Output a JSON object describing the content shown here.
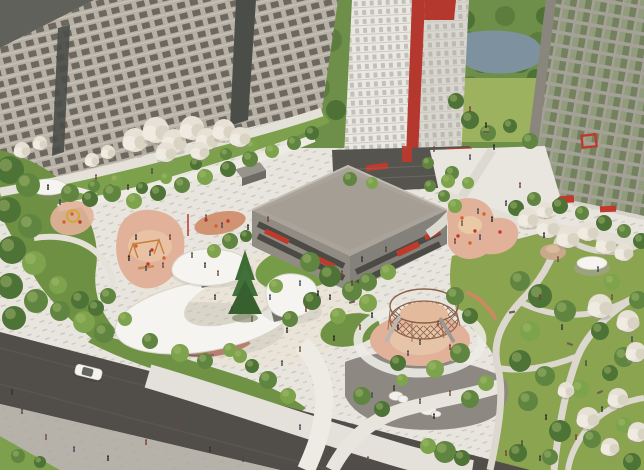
{
  "meta": {
    "type": "architectural-aerial-render",
    "title": "Residential courtyard masterplan — aerial visualization",
    "width": 644,
    "height": 470
  },
  "palette": {
    "plaza": "#e8e5de",
    "plaza_warm": "#eadfce",
    "stipple": "#a9a49a",
    "path": "#edebe4",
    "path_grey": "#d9d5cc",
    "path_narrow": "#dcd8cf",
    "road": "#514e4a",
    "road_streak": "#5c5954",
    "sidewalk": "#b6b2aa",
    "grass_corner": "#7da04e",
    "lawn": "#8ba450",
    "lawn_light": "#9cb25f",
    "garden_green": "#7ca04b",
    "edge_green": "#6d9043",
    "roadside_green": "#6f9245",
    "backdrop_green": "#6e8f49",
    "lake": "#7d929e",
    "dark_plaza": "#8d8982",
    "boulder": "#f2f0ea",
    "bldg_left": "#b6b0a5",
    "bldg_left_base": "#97928a",
    "glazing": "#4a4d48",
    "roof_dark": "#60615a",
    "tower_front": "#eae8e2",
    "tower_side": "#d9d6cf",
    "tower_base": "#56544f",
    "red": "#b5382e",
    "red_bright": "#c0392b",
    "bldg_right_frame": "#a5a198",
    "glass_a": "#73815f",
    "glass_b": "#99a383",
    "podium_roof": "#a9a399",
    "podium_face": "#908c84",
    "podium_face2": "#84807a",
    "podium_band": "#4c4a45",
    "canopy": "#f5f4f0",
    "canopy_edge": "#d8d4cb",
    "pavilion_wall": "#b97f6e",
    "pavilion_dark": "#6b6862",
    "pg_pink": "#e2b199",
    "pg_sand": "#ecd0a8",
    "pg_terra": "#cf8a66",
    "equip_orange": "#d2622e",
    "structure_brown": "#8a5f46",
    "spruce": "#3f6b34",
    "car_body": "#f4f3ef",
    "bush_colors": [
      "#4e7336",
      "#5f8540",
      "#7da34c",
      "#93ad5b"
    ],
    "people_colors": [
      "#33312e",
      "#4a4640",
      "#6e4a3c",
      "#39465c",
      "#262522",
      "#7b3b32"
    ]
  },
  "scene": {
    "buildings": [
      {
        "id": "left-slab",
        "label": "beige residential slab with glazed stair strips"
      },
      {
        "id": "white-tower",
        "label": "white tower with red corner stripe and red crown block"
      },
      {
        "id": "right-slab",
        "label": "grey slab with green reflective glazing and red framed window"
      },
      {
        "id": "podium",
        "label": "low grey podium building with louvered bands and red awnings"
      },
      {
        "id": "shed",
        "label": "small utility pavilion"
      }
    ],
    "canopies": [
      {
        "id": "crescent-canopy",
        "label": "white crescent canopy over terracotta pavilion"
      },
      {
        "id": "wave-canopy",
        "label": "white wavy canopy pavilion"
      },
      {
        "id": "round-canopy",
        "label": "white round canopy pavilion"
      },
      {
        "id": "umbrella-left",
        "label": "small white umbrella"
      },
      {
        "id": "umbrella-right",
        "label": "park umbrella on patio"
      }
    ],
    "playgrounds": [
      {
        "id": "swing-playground",
        "label": "pink playground with swings"
      },
      {
        "id": "toddler-playground",
        "label": "small pink playground with yellow ring"
      },
      {
        "id": "terra-playground",
        "label": "terracotta activity patch"
      },
      {
        "id": "dome-playground",
        "label": "circular rope climbing pavilion with slides"
      },
      {
        "id": "east-playground",
        "label": "pink playground with orange equipment"
      }
    ],
    "road": {
      "car": "white sedan",
      "lanes": "two-lane asphalt with sidewalk"
    },
    "backdrop": {
      "lake": true,
      "tree_line": true
    },
    "people": [
      [
        12,
        395
      ],
      [
        22,
        414
      ],
      [
        46,
        440
      ],
      [
        74,
        452
      ],
      [
        108,
        461
      ],
      [
        146,
        445
      ],
      [
        210,
        452
      ],
      [
        243,
        462
      ],
      [
        178,
        430
      ],
      [
        60,
        205
      ],
      [
        48,
        190
      ],
      [
        96,
        180
      ],
      [
        128,
        190
      ],
      [
        152,
        174
      ],
      [
        206,
        220
      ],
      [
        222,
        228
      ],
      [
        248,
        230
      ],
      [
        268,
        222
      ],
      [
        136,
        240
      ],
      [
        150,
        256
      ],
      [
        163,
        268
      ],
      [
        146,
        271
      ],
      [
        129,
        261
      ],
      [
        170,
        240
      ],
      [
        215,
        300
      ],
      [
        232,
        312
      ],
      [
        252,
        322
      ],
      [
        270,
        300
      ],
      [
        287,
        333
      ],
      [
        306,
        312
      ],
      [
        330,
        300
      ],
      [
        352,
        286
      ],
      [
        300,
        352
      ],
      [
        282,
        366
      ],
      [
        334,
        341
      ],
      [
        360,
        330
      ],
      [
        205,
        268
      ],
      [
        192,
        258
      ],
      [
        218,
        276
      ],
      [
        300,
        286
      ],
      [
        318,
        296
      ],
      [
        342,
        276
      ],
      [
        362,
        262
      ],
      [
        386,
        252
      ],
      [
        434,
        152
      ],
      [
        470,
        160
      ],
      [
        494,
        150
      ],
      [
        520,
        188
      ],
      [
        506,
        206
      ],
      [
        478,
        214
      ],
      [
        462,
        226
      ],
      [
        480,
        240
      ],
      [
        492,
        222
      ],
      [
        455,
        244
      ],
      [
        398,
        330
      ],
      [
        420,
        345
      ],
      [
        438,
        326
      ],
      [
        408,
        356
      ],
      [
        372,
        318
      ],
      [
        450,
        350
      ],
      [
        394,
        391
      ],
      [
        420,
        404
      ],
      [
        450,
        396
      ],
      [
        372,
        398
      ],
      [
        434,
        419
      ],
      [
        540,
        300
      ],
      [
        562,
        330
      ],
      [
        586,
        366
      ],
      [
        612,
        300
      ],
      [
        632,
        342
      ],
      [
        546,
        420
      ],
      [
        576,
        440
      ],
      [
        602,
        412
      ],
      [
        522,
        446
      ],
      [
        558,
        262
      ],
      [
        598,
        272
      ],
      [
        544,
        238
      ],
      [
        506,
        456
      ],
      [
        540,
        461
      ],
      [
        330,
        452
      ],
      [
        368,
        462
      ],
      [
        300,
        430
      ],
      [
        486,
        128
      ],
      [
        470,
        112
      ]
    ],
    "blossom_trees": [
      [
        135,
        140,
        12
      ],
      [
        156,
        130,
        13
      ],
      [
        174,
        141,
        12
      ],
      [
        192,
        128,
        12
      ],
      [
        207,
        139,
        11
      ],
      [
        224,
        130,
        11
      ],
      [
        240,
        137,
        10
      ],
      [
        166,
        152,
        10
      ],
      [
        200,
        151,
        9
      ],
      [
        22,
        150,
        8
      ],
      [
        40,
        143,
        7
      ],
      [
        92,
        160,
        7
      ],
      [
        108,
        152,
        7
      ],
      [
        528,
        218,
        10
      ],
      [
        548,
        227,
        11
      ],
      [
        568,
        237,
        11
      ],
      [
        588,
        231,
        10
      ],
      [
        606,
        244,
        10
      ],
      [
        624,
        252,
        9
      ],
      [
        545,
        210,
        8
      ],
      [
        600,
        306,
        12
      ],
      [
        628,
        321,
        11
      ],
      [
        636,
        352,
        10
      ],
      [
        566,
        390,
        8
      ],
      [
        588,
        418,
        11
      ],
      [
        618,
        398,
        10
      ],
      [
        638,
        432,
        10
      ],
      [
        610,
        447,
        9
      ]
    ],
    "bushes": [
      [
        10,
        170,
        14,
        0
      ],
      [
        28,
        185,
        12,
        1
      ],
      [
        8,
        210,
        13,
        0
      ],
      [
        30,
        226,
        12,
        1
      ],
      [
        12,
        250,
        14,
        0
      ],
      [
        34,
        263,
        12,
        2
      ],
      [
        10,
        286,
        13,
        0
      ],
      [
        36,
        301,
        12,
        1
      ],
      [
        14,
        318,
        12,
        0
      ],
      [
        60,
        311,
        10,
        1
      ],
      [
        84,
        322,
        11,
        2
      ],
      [
        104,
        333,
        10,
        1
      ],
      [
        58,
        285,
        9,
        2
      ],
      [
        80,
        300,
        9,
        0
      ],
      [
        108,
        296,
        8,
        1
      ],
      [
        96,
        308,
        8,
        0
      ],
      [
        125,
        319,
        7,
        2
      ],
      [
        150,
        341,
        8,
        1
      ],
      [
        180,
        353,
        9,
        2
      ],
      [
        205,
        361,
        8,
        1
      ],
      [
        230,
        350,
        7,
        2
      ],
      [
        310,
        262,
        10,
        1
      ],
      [
        330,
        276,
        11,
        0
      ],
      [
        352,
        291,
        10,
        1
      ],
      [
        368,
        303,
        9,
        2
      ],
      [
        312,
        301,
        9,
        0
      ],
      [
        290,
        319,
        8,
        1
      ],
      [
        338,
        316,
        8,
        2
      ],
      [
        276,
        286,
        7,
        2
      ],
      [
        230,
        241,
        8,
        1
      ],
      [
        214,
        251,
        7,
        2
      ],
      [
        246,
        236,
        6,
        0
      ],
      [
        368,
        282,
        9,
        1
      ],
      [
        388,
        272,
        8,
        2
      ],
      [
        455,
        296,
        9,
        1
      ],
      [
        470,
        316,
        8,
        0
      ],
      [
        460,
        353,
        10,
        1
      ],
      [
        435,
        369,
        9,
        2
      ],
      [
        398,
        363,
        8,
        0
      ],
      [
        362,
        396,
        9,
        1
      ],
      [
        382,
        409,
        8,
        0
      ],
      [
        470,
        399,
        9,
        1
      ],
      [
        486,
        383,
        8,
        2
      ],
      [
        402,
        380,
        6,
        2
      ],
      [
        520,
        281,
        10,
        1
      ],
      [
        540,
        296,
        12,
        0
      ],
      [
        565,
        311,
        11,
        1
      ],
      [
        530,
        331,
        10,
        2
      ],
      [
        600,
        331,
        9,
        0
      ],
      [
        624,
        357,
        10,
        1
      ],
      [
        520,
        361,
        11,
        0
      ],
      [
        545,
        376,
        10,
        1
      ],
      [
        580,
        389,
        9,
        2
      ],
      [
        610,
        373,
        8,
        0
      ],
      [
        528,
        401,
        10,
        1
      ],
      [
        560,
        431,
        11,
        0
      ],
      [
        592,
        439,
        9,
        1
      ],
      [
        624,
        425,
        8,
        2
      ],
      [
        518,
        453,
        9,
        0
      ],
      [
        550,
        457,
        8,
        1
      ],
      [
        632,
        462,
        9,
        0
      ],
      [
        638,
        300,
        9,
        1
      ],
      [
        612,
        282,
        8,
        2
      ],
      [
        516,
        208,
        8,
        0
      ],
      [
        534,
        199,
        7,
        1
      ],
      [
        560,
        206,
        8,
        0
      ],
      [
        582,
        213,
        7,
        1
      ],
      [
        604,
        223,
        8,
        0
      ],
      [
        624,
        231,
        7,
        1
      ],
      [
        641,
        241,
        8,
        0
      ],
      [
        452,
        173,
        7,
        1
      ],
      [
        468,
        183,
        6,
        2
      ],
      [
        428,
        163,
        6,
        1
      ],
      [
        70,
        193,
        9,
        1
      ],
      [
        90,
        199,
        8,
        0
      ],
      [
        112,
        193,
        9,
        1
      ],
      [
        134,
        201,
        8,
        2
      ],
      [
        158,
        193,
        8,
        0
      ],
      [
        182,
        185,
        8,
        1
      ],
      [
        205,
        177,
        8,
        2
      ],
      [
        228,
        169,
        8,
        0
      ],
      [
        250,
        159,
        8,
        1
      ],
      [
        272,
        151,
        7,
        2
      ],
      [
        294,
        143,
        7,
        1
      ],
      [
        312,
        133,
        7,
        0
      ],
      [
        252,
        146,
        6,
        2
      ],
      [
        226,
        154,
        6,
        1
      ],
      [
        196,
        164,
        6,
        0
      ],
      [
        166,
        178,
        6,
        2
      ],
      [
        142,
        188,
        6,
        0
      ],
      [
        116,
        180,
        6,
        2
      ],
      [
        94,
        186,
        6,
        1
      ],
      [
        350,
        179,
        7,
        1
      ],
      [
        372,
        183,
        6,
        2
      ],
      [
        430,
        186,
        6,
        1
      ],
      [
        448,
        181,
        7,
        2
      ],
      [
        470,
        120,
        9,
        0
      ],
      [
        488,
        133,
        8,
        1
      ],
      [
        510,
        126,
        7,
        0
      ],
      [
        530,
        141,
        8,
        1
      ],
      [
        456,
        101,
        8,
        0
      ],
      [
        455,
        206,
        7,
        2
      ],
      [
        444,
        196,
        6,
        1
      ],
      [
        268,
        380,
        9,
        1
      ],
      [
        288,
        396,
        8,
        2
      ],
      [
        252,
        366,
        7,
        0
      ],
      [
        240,
        356,
        7,
        2
      ],
      [
        445,
        452,
        11,
        1
      ],
      [
        428,
        446,
        8,
        2
      ],
      [
        462,
        458,
        8,
        0
      ],
      [
        18,
        456,
        7,
        1
      ],
      [
        40,
        462,
        6,
        0
      ]
    ],
    "backdrop_trees": [
      [
        302,
        62,
        14
      ],
      [
        318,
        88,
        12
      ],
      [
        300,
        112,
        12
      ],
      [
        330,
        40,
        12
      ],
      [
        336,
        110,
        10
      ],
      [
        310,
        10,
        12
      ],
      [
        296,
        30,
        12
      ],
      [
        465,
        42,
        12
      ],
      [
        482,
        62,
        11
      ],
      [
        500,
        46,
        10
      ],
      [
        520,
        62,
        11
      ],
      [
        538,
        42,
        10
      ],
      [
        465,
        20,
        10
      ],
      [
        505,
        16,
        10
      ],
      [
        545,
        16,
        9
      ],
      [
        470,
        86,
        10
      ],
      [
        494,
        96,
        9
      ],
      [
        518,
        94,
        9
      ],
      [
        536,
        78,
        9
      ]
    ],
    "benches": [
      [
        352,
        302,
        -15
      ],
      [
        512,
        312,
        -10
      ],
      [
        570,
        344,
        20
      ],
      [
        600,
        392,
        -25
      ],
      [
        486,
        132,
        0
      ]
    ],
    "equipment": [
      [
        462,
        218
      ],
      [
        475,
        231
      ],
      [
        484,
        214
      ],
      [
        458,
        236
      ],
      [
        470,
        243
      ],
      [
        206,
        220
      ],
      [
        216,
        226
      ],
      [
        228,
        221
      ],
      [
        136,
        246
      ],
      [
        152,
        250
      ],
      [
        164,
        258
      ],
      [
        148,
        264
      ],
      [
        72,
        214
      ],
      [
        80,
        222
      ],
      [
        64,
        222
      ],
      [
        500,
        232
      ]
    ]
  }
}
